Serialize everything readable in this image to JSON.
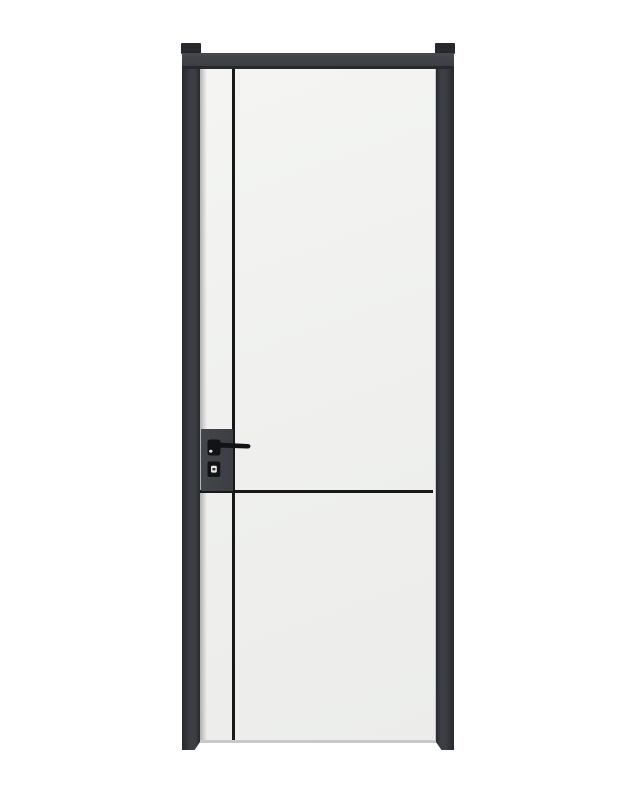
{
  "scene": {
    "type": "product-photo",
    "subject": "Minimalist interior door: white leaf with thin black inlay lines, charcoal-black aluminium frame, black lever handle and key escutcheon, shown closed on a plain white background"
  },
  "parts": {
    "assembly": "door with black frame",
    "frame_cap_left": "frame top cap left",
    "frame_cap_right": "frame top cap right",
    "frame_header": "frame header bar",
    "frame_jamb_left": "left frame jamb with floor foot",
    "frame_jamb_right": "right frame jamb with floor foot",
    "door_leaf": "white door leaf",
    "vertical_groove": "black vertical inlay line",
    "horizontal_groove": "black horizontal inlay line",
    "handle_panel": "black lock side panel",
    "handle": "black lever door handle",
    "escutcheon": "key cylinder escutcheon with metal emblem"
  },
  "colors": {
    "background": "#ffffff",
    "frame": "#3b3e43",
    "frame_dark": "#27292c",
    "frame_light": "#47494e",
    "leaf": "#f4f5f3",
    "leaf_edge": "#c8cac8",
    "groove": "#17181a",
    "panel": "#43464a",
    "hardware": "#121316",
    "emblem": "#ece9e4"
  }
}
